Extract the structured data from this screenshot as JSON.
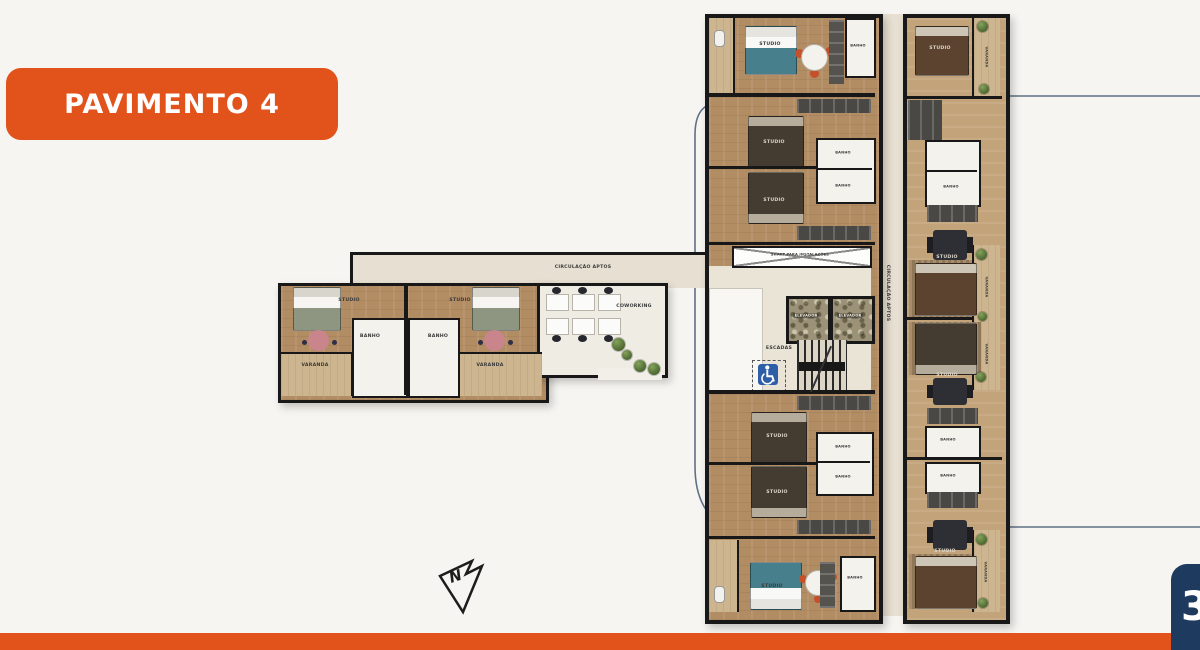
{
  "title_badge": "PAVIMENTO 4",
  "page_tab": {
    "number": "3"
  },
  "north_arrow": {
    "letter": "N"
  },
  "colors": {
    "orange": "#E2521B",
    "navy": "#1F3A5F",
    "wall": "#181818",
    "wood_floor": "#B28C63",
    "wood_light": "#C3A379",
    "balcony": "#CDB68F",
    "bath_white": "#F4F2ED",
    "corridor": "#E7E0D2",
    "teal_bed": "#47808C",
    "annotation_line": "#5E7186",
    "plant_green": "#4C6630",
    "wheelchair_blue": "#2E5EA8",
    "background": "#F7F5F1"
  },
  "plan_labels": {
    "circulacao_aptos": "CIRCULAÇÃO APTOS",
    "coworking": "COWORKING",
    "studio": "STUDIO",
    "banho": "BANHO",
    "varanda": "VARANDA",
    "escadas": "ESCADAS",
    "elevador": "ELEVADOR",
    "shaft": "SHAFT PARA INSTALAÇÕES"
  }
}
